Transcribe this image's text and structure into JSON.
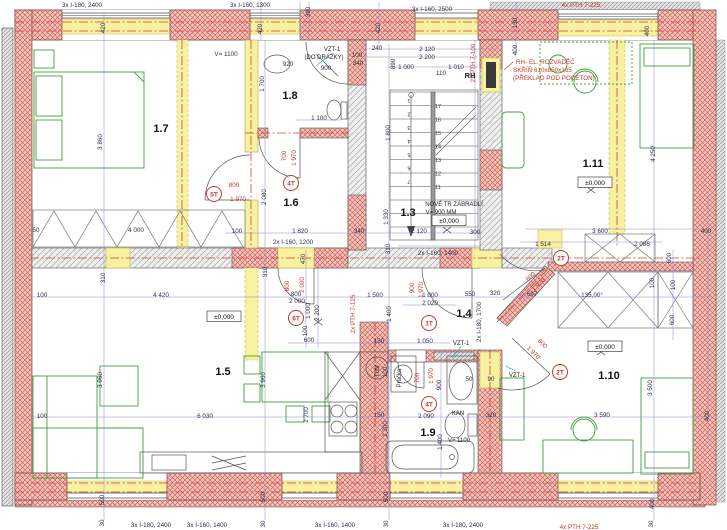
{
  "colors": {
    "exterior_wall_hatch": "#c4564e",
    "exterior_wall_fill": "#f6c3bb",
    "existing_masonry_hatch": "#a6a6a6",
    "new_masonry_yellow": "#f7f1a0",
    "furniture_green": "#3f9f3f",
    "dimension_blue": "#8b8bd0",
    "annotation_red": "#c0392b",
    "axis_red": "#d04038"
  },
  "rooms": [
    {
      "t": "1.7",
      "x": 161,
      "y": 132
    },
    {
      "t": "1.8",
      "x": 290,
      "y": 99
    },
    {
      "t": "1.6",
      "x": 291,
      "y": 206
    },
    {
      "t": "1.3",
      "x": 408,
      "y": 216
    },
    {
      "t": "1.4",
      "x": 464,
      "y": 317
    },
    {
      "t": "1.5",
      "x": 223,
      "y": 375
    },
    {
      "t": "1.9",
      "x": 428,
      "y": 436
    },
    {
      "t": "1.10",
      "x": 609,
      "y": 379
    },
    {
      "t": "1.11",
      "x": 593,
      "y": 167
    }
  ],
  "labels": {
    "black_h": [
      {
        "t": "3x I-180, 2400",
        "x": 82,
        "y": 7
      },
      {
        "t": "3x I-160, 1300",
        "x": 250,
        "y": 7
      },
      {
        "t": "3x I-160, 2500",
        "x": 432,
        "y": 11
      },
      {
        "t": "V= 1100",
        "x": 226,
        "y": 56
      },
      {
        "t": "920",
        "x": 288,
        "y": 66
      },
      {
        "t": "900",
        "x": 326,
        "y": 70
      },
      {
        "t": "100",
        "x": 357,
        "y": 57
      },
      {
        "t": "340",
        "x": 358,
        "y": 65
      },
      {
        "t": "240",
        "x": 377,
        "y": 50
      },
      {
        "t": "2 120",
        "x": 427,
        "y": 51
      },
      {
        "t": "2 200",
        "x": 427,
        "y": 59
      },
      {
        "t": "1 000",
        "x": 406,
        "y": 69
      },
      {
        "t": "1 010",
        "x": 456,
        "y": 69
      },
      {
        "t": "110",
        "x": 441,
        "y": 75
      },
      {
        "t": "1 100",
        "x": 319,
        "y": 120
      },
      {
        "t": "100",
        "x": 237,
        "y": 233
      },
      {
        "t": "1 820",
        "x": 300,
        "y": 233
      },
      {
        "t": "340",
        "x": 359,
        "y": 233
      },
      {
        "t": "2x I-160, 1200",
        "x": 293,
        "y": 244
      },
      {
        "t": "50",
        "x": 36,
        "y": 232
      },
      {
        "t": "4 000",
        "x": 136,
        "y": 232
      },
      {
        "t": "2 120",
        "x": 419,
        "y": 233
      },
      {
        "t": "300",
        "x": 475,
        "y": 234
      },
      {
        "t": "2x I-160, 1400",
        "x": 438,
        "y": 255
      },
      {
        "t": "1 514",
        "x": 543,
        "y": 246
      },
      {
        "t": "2 086",
        "x": 642,
        "y": 246
      },
      {
        "t": "3 600",
        "x": 600,
        "y": 233
      },
      {
        "t": "400",
        "x": 706,
        "y": 233
      },
      {
        "t": "100",
        "x": 42,
        "y": 297
      },
      {
        "t": "4 420",
        "x": 161,
        "y": 297
      },
      {
        "t": "800",
        "x": 296,
        "y": 296
      },
      {
        "t": "2 000",
        "x": 297,
        "y": 303
      },
      {
        "t": "1 500",
        "x": 375,
        "y": 297
      },
      {
        "t": "1 000",
        "x": 430,
        "y": 297
      },
      {
        "t": "2 020",
        "x": 430,
        "y": 305
      },
      {
        "t": "550",
        "x": 470,
        "y": 296
      },
      {
        "t": "320",
        "x": 495,
        "y": 295
      },
      {
        "t": "697",
        "x": 532,
        "y": 296
      },
      {
        "t": "135,00°",
        "x": 592,
        "y": 297
      },
      {
        "t": "600",
        "x": 309,
        "y": 342
      },
      {
        "t": "150",
        "x": 379,
        "y": 343
      },
      {
        "t": "1 050",
        "x": 425,
        "y": 343
      },
      {
        "t": "100",
        "x": 42,
        "y": 418
      },
      {
        "t": "6 030",
        "x": 205,
        "y": 418
      },
      {
        "t": "150",
        "x": 379,
        "y": 417
      },
      {
        "t": "2 090",
        "x": 426,
        "y": 418
      },
      {
        "t": "320",
        "x": 491,
        "y": 417
      },
      {
        "t": "3 590",
        "x": 602,
        "y": 417
      },
      {
        "t": "50",
        "x": 469,
        "y": 381
      },
      {
        "t": "90",
        "x": 491,
        "y": 381
      },
      {
        "t": "3x I-180, 2400",
        "x": 151,
        "y": 527
      },
      {
        "t": "3x I-160, 1400",
        "x": 207,
        "y": 527
      },
      {
        "t": "3x I-160, 1400",
        "x": 335,
        "y": 527
      },
      {
        "t": "3x I-180, 2400",
        "x": 463,
        "y": 527
      }
    ],
    "black_v": [
      {
        "t": "420",
        "x": 105,
        "y": 28
      },
      {
        "t": "390",
        "x": 310,
        "y": 12
      },
      {
        "t": "420",
        "x": 262,
        "y": 29
      },
      {
        "t": "420",
        "x": 380,
        "y": 28
      },
      {
        "t": "130",
        "x": 517,
        "y": 23
      },
      {
        "t": "400",
        "x": 517,
        "y": 50
      },
      {
        "t": "400",
        "x": 649,
        "y": 31
      },
      {
        "t": "3 860",
        "x": 102,
        "y": 142
      },
      {
        "t": "1 700",
        "x": 264,
        "y": 84
      },
      {
        "t": "890",
        "x": 395,
        "y": 64
      },
      {
        "t": "1 800",
        "x": 390,
        "y": 133
      },
      {
        "t": "2 080",
        "x": 266,
        "y": 197
      },
      {
        "t": "1 330",
        "x": 388,
        "y": 217
      },
      {
        "t": "310",
        "x": 390,
        "y": 249
      },
      {
        "t": "470",
        "x": 305,
        "y": 259
      },
      {
        "t": "310",
        "x": 267,
        "y": 272
      },
      {
        "t": "310",
        "x": 105,
        "y": 278
      },
      {
        "t": "4 250",
        "x": 655,
        "y": 154
      },
      {
        "t": "1 000",
        "x": 310,
        "y": 311
      },
      {
        "t": "2 200",
        "x": 319,
        "y": 313
      },
      {
        "t": "100",
        "x": 307,
        "y": 331
      },
      {
        "t": "1 400",
        "x": 391,
        "y": 314
      },
      {
        "t": "2x I-180, 1700",
        "x": 481,
        "y": 322
      },
      {
        "t": "600",
        "x": 671,
        "y": 258
      },
      {
        "t": "100",
        "x": 654,
        "y": 283
      },
      {
        "t": "100",
        "x": 675,
        "y": 285
      },
      {
        "t": "600",
        "x": 674,
        "y": 320
      },
      {
        "t": "3 500",
        "x": 652,
        "y": 388
      },
      {
        "t": "400",
        "x": 709,
        "y": 416
      },
      {
        "t": "3 960",
        "x": 102,
        "y": 380
      },
      {
        "t": "3 960",
        "x": 265,
        "y": 380
      },
      {
        "t": "2 700",
        "x": 308,
        "y": 415
      },
      {
        "t": "100",
        "x": 387,
        "y": 372
      },
      {
        "t": "900",
        "x": 441,
        "y": 385
      },
      {
        "t": "2 300",
        "x": 387,
        "y": 429
      },
      {
        "t": "1 400",
        "x": 442,
        "y": 442
      },
      {
        "t": "500",
        "x": 104,
        "y": 500
      },
      {
        "t": "30",
        "x": 104,
        "y": 523
      },
      {
        "t": "500",
        "x": 265,
        "y": 497
      },
      {
        "t": "30",
        "x": 265,
        "y": 524
      },
      {
        "t": "500",
        "x": 388,
        "y": 497
      },
      {
        "t": "30",
        "x": 388,
        "y": 524
      },
      {
        "t": "400",
        "x": 654,
        "y": 504
      },
      {
        "t": "30",
        "x": 653,
        "y": 524
      }
    ],
    "red_labels": [
      {
        "t": "4x PTH 7-225",
        "x": 581,
        "y": 7
      },
      {
        "t": "2x PTH 7-100",
        "x": 475,
        "y": 63,
        "r": -90
      },
      {
        "t": "800",
        "x": 234,
        "y": 187
      },
      {
        "t": "1 970",
        "x": 238,
        "y": 201
      },
      {
        "t": "700",
        "x": 286,
        "y": 156,
        "r": -90
      },
      {
        "t": "1 970",
        "x": 296,
        "y": 158,
        "r": -90
      },
      {
        "t": "800",
        "x": 289,
        "y": 286,
        "r": -90
      },
      {
        "t": "2 000",
        "x": 304,
        "y": 285,
        "r": -90
      },
      {
        "t": "2x PTH 7-125",
        "x": 355,
        "y": 314,
        "r": -90
      },
      {
        "t": "900",
        "x": 414,
        "y": 288,
        "r": -90
      },
      {
        "t": "1 970",
        "x": 423,
        "y": 290,
        "r": -90
      },
      {
        "t": "700",
        "x": 419,
        "y": 378,
        "r": -90
      },
      {
        "t": "1 970",
        "x": 433,
        "y": 376,
        "r": -90
      },
      {
        "t": "800",
        "x": 532,
        "y": 278,
        "r": -45
      },
      {
        "t": "1 970",
        "x": 540,
        "y": 286,
        "r": -45
      },
      {
        "t": "800",
        "x": 541,
        "y": 345,
        "r": 45
      },
      {
        "t": "1 970",
        "x": 532,
        "y": 354,
        "r": 45
      },
      {
        "t": "RH- EL. ROZVADĚČ",
        "x": 516,
        "y": 64,
        "a": "start"
      },
      {
        "t": "SKŘÍŇ 610x850x165",
        "x": 513,
        "y": 72,
        "a": "start"
      },
      {
        "t": "(PŘEKLAD POD POCETON)",
        "x": 513,
        "y": 80,
        "a": "start"
      },
      {
        "t": "4x PTH 7-225",
        "x": 579,
        "y": 529
      }
    ],
    "notes": [
      {
        "t": "VZT-1",
        "x": 332,
        "y": 51
      },
      {
        "t": "(DO DRÁŽKY)",
        "x": 324,
        "y": 59
      },
      {
        "t": "RH",
        "x": 470,
        "y": 78,
        "cls": "bold"
      },
      {
        "t": "NOVÉ TR ZÁBRADLÍ",
        "x": 454,
        "y": 206
      },
      {
        "t": "V= 900 MM",
        "x": 441,
        "y": 214
      },
      {
        "t": "VZT-1",
        "x": 461,
        "y": 345
      },
      {
        "t": "VZT-1",
        "x": 517,
        "y": 377
      },
      {
        "t": "KAN",
        "x": 458,
        "y": 415
      },
      {
        "t": "V= 1100",
        "x": 459,
        "y": 442
      },
      {
        "t": "TUV",
        "x": 379,
        "y": 371,
        "r": -90
      },
      {
        "t": "Pračka",
        "x": 401,
        "y": 378,
        "r": -90
      }
    ]
  },
  "door_tags": [
    {
      "t": "5T",
      "x": 214,
      "y": 194
    },
    {
      "t": "4T",
      "x": 291,
      "y": 183
    },
    {
      "t": "6T",
      "x": 296,
      "y": 318
    },
    {
      "t": "1T",
      "x": 429,
      "y": 323
    },
    {
      "t": "4T",
      "x": 429,
      "y": 404
    },
    {
      "t": "2T",
      "x": 561,
      "y": 258
    },
    {
      "t": "2T",
      "x": 560,
      "y": 372
    }
  ],
  "levels": [
    {
      "t": "±0,000",
      "x": 224,
      "y": 319
    },
    {
      "t": "±0,000",
      "x": 449,
      "y": 223
    },
    {
      "t": "±0,000",
      "x": 595,
      "y": 185
    },
    {
      "t": "±0,000",
      "x": 605,
      "y": 349
    }
  ],
  "stairs": {
    "left": [
      "1",
      "2",
      "3",
      "4",
      "5",
      "6",
      "7"
    ],
    "right": [
      "17",
      "16",
      "15",
      "14",
      "13",
      "12",
      "11"
    ]
  }
}
